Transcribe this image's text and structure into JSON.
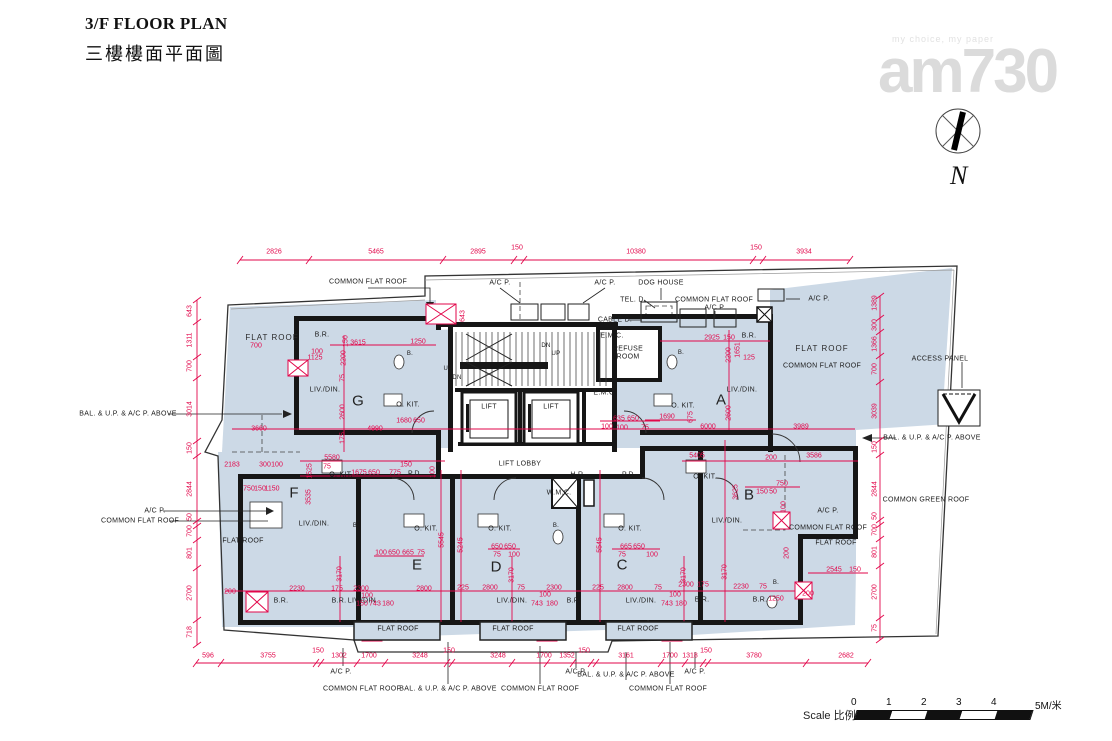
{
  "header": {
    "title_en": "3/F FLOOR PLAN",
    "title_zh": "三樓樓面平面圖"
  },
  "watermark": {
    "tagline": "my choice, my paper",
    "logo": "am730"
  },
  "compass": {
    "label": "N"
  },
  "scale_bar": {
    "label": "Scale 比例:",
    "ticks": [
      "0",
      "1",
      "2",
      "3",
      "4"
    ],
    "unit": "5M/米"
  },
  "colors": {
    "dimension": "#e2064a",
    "plan_fill": "#ccd9e6",
    "wall": "#161616"
  },
  "plan": {
    "flat_labels": [
      {
        "t": "G",
        "x": 358,
        "y": 401
      },
      {
        "t": "A",
        "x": 721,
        "y": 400
      },
      {
        "t": "F",
        "x": 294,
        "y": 493
      },
      {
        "t": "B",
        "x": 749,
        "y": 495
      },
      {
        "t": "E",
        "x": 417,
        "y": 565
      },
      {
        "t": "D",
        "x": 496,
        "y": 567
      },
      {
        "t": "C",
        "x": 622,
        "y": 565
      }
    ],
    "text_labels": [
      {
        "t": "FLAT ROOF",
        "x": 272,
        "y": 338,
        "s": "b"
      },
      {
        "t": "FLAT ROOF",
        "x": 822,
        "y": 349,
        "s": "b"
      },
      {
        "t": "FLAT ROOF",
        "x": 836,
        "y": 543
      },
      {
        "t": "FLAT ROOF",
        "x": 243,
        "y": 541
      },
      {
        "t": "FLAT ROOF",
        "x": 398,
        "y": 629
      },
      {
        "t": "FLAT ROOF",
        "x": 513,
        "y": 629
      },
      {
        "t": "FLAT ROOF",
        "x": 638,
        "y": 629
      },
      {
        "t": "COMMON FLAT ROOF",
        "x": 368,
        "y": 282
      },
      {
        "t": "COMMON FLAT ROOF",
        "x": 714,
        "y": 300
      },
      {
        "t": "COMMON FLAT ROOF",
        "x": 822,
        "y": 366
      },
      {
        "t": "COMMON FLAT ROOF",
        "x": 828,
        "y": 528
      },
      {
        "t": "COMMON FLAT ROOF",
        "x": 140,
        "y": 521
      },
      {
        "t": "COMMON FLAT ROOF",
        "x": 362,
        "y": 689
      },
      {
        "t": "COMMON FLAT ROOF",
        "x": 540,
        "y": 689
      },
      {
        "t": "COMMON FLAT ROOF",
        "x": 668,
        "y": 689
      },
      {
        "t": "A/C P.",
        "x": 500,
        "y": 283
      },
      {
        "t": "A/C P.",
        "x": 605,
        "y": 283
      },
      {
        "t": "A/C P.",
        "x": 715,
        "y": 308
      },
      {
        "t": "A/C P.",
        "x": 819,
        "y": 299
      },
      {
        "t": "A/C P.",
        "x": 155,
        "y": 511
      },
      {
        "t": "A/C P.",
        "x": 828,
        "y": 511
      },
      {
        "t": "A/C P.",
        "x": 341,
        "y": 672
      },
      {
        "t": "A/C P.",
        "x": 576,
        "y": 672
      },
      {
        "t": "A/C P.",
        "x": 695,
        "y": 672
      },
      {
        "t": "BAL. & U.P. & A/C P. ABOVE",
        "x": 128,
        "y": 414
      },
      {
        "t": "BAL. & U.P. & A/C P. ABOVE",
        "x": 932,
        "y": 438
      },
      {
        "t": "BAL. & U.P. & A/C P. ABOVE",
        "x": 448,
        "y": 689
      },
      {
        "t": "BAL. & U.P. & A/C P. ABOVE",
        "x": 626,
        "y": 675
      },
      {
        "t": "DOG HOUSE",
        "x": 661,
        "y": 283
      },
      {
        "t": "TEL. D.",
        "x": 633,
        "y": 300
      },
      {
        "t": "CABLE D.",
        "x": 615,
        "y": 320
      },
      {
        "t": "ACCESS PANEL",
        "x": 940,
        "y": 359
      },
      {
        "t": "COMMON GREEN ROOF",
        "x": 926,
        "y": 500
      },
      {
        "t": "REFUSE",
        "x": 628,
        "y": 349
      },
      {
        "t": "ROOM",
        "x": 628,
        "y": 357
      },
      {
        "t": "LIFT",
        "x": 489,
        "y": 407
      },
      {
        "t": "LIFT",
        "x": 551,
        "y": 407
      },
      {
        "t": "LIFT LOBBY",
        "x": 520,
        "y": 464
      },
      {
        "t": "H.R.",
        "x": 578,
        "y": 475
      },
      {
        "t": "P.D.",
        "x": 629,
        "y": 475
      },
      {
        "t": "P.D.",
        "x": 415,
        "y": 474
      },
      {
        "t": "W.M.C.",
        "x": 559,
        "y": 493
      },
      {
        "t": "E.M.C.",
        "x": 612,
        "y": 336
      },
      {
        "t": "E.M.C.",
        "x": 605,
        "y": 393
      },
      {
        "t": "UP",
        "x": 556,
        "y": 354,
        "s": "t"
      },
      {
        "t": "DN",
        "x": 546,
        "y": 346,
        "s": "t"
      },
      {
        "t": "UP",
        "x": 448,
        "y": 369,
        "s": "t"
      },
      {
        "t": "DN",
        "x": 457,
        "y": 378,
        "s": "t"
      },
      {
        "t": "O. KIT.",
        "x": 408,
        "y": 405
      },
      {
        "t": "O. KIT.",
        "x": 683,
        "y": 406
      },
      {
        "t": "O. KIT.",
        "x": 341,
        "y": 475
      },
      {
        "t": "O. KIT.",
        "x": 705,
        "y": 477
      },
      {
        "t": "O. KIT.",
        "x": 426,
        "y": 529
      },
      {
        "t": "O. KIT.",
        "x": 500,
        "y": 529
      },
      {
        "t": "O. KIT.",
        "x": 630,
        "y": 529
      },
      {
        "t": "LIV./DIN.",
        "x": 325,
        "y": 390
      },
      {
        "t": "LIV./DIN.",
        "x": 742,
        "y": 390
      },
      {
        "t": "LIV./DIN.",
        "x": 314,
        "y": 524
      },
      {
        "t": "LIV./DIN.",
        "x": 727,
        "y": 521
      },
      {
        "t": "LIV./DIN.",
        "x": 363,
        "y": 601
      },
      {
        "t": "LIV./DIN.",
        "x": 512,
        "y": 601
      },
      {
        "t": "LIV./DIN.",
        "x": 641,
        "y": 601
      },
      {
        "t": "B.R.",
        "x": 322,
        "y": 335
      },
      {
        "t": "B.R.",
        "x": 749,
        "y": 336
      },
      {
        "t": "B.R.",
        "x": 281,
        "y": 601
      },
      {
        "t": "B.R.",
        "x": 339,
        "y": 601
      },
      {
        "t": "B.R.",
        "x": 574,
        "y": 601
      },
      {
        "t": "B.R.",
        "x": 702,
        "y": 600
      },
      {
        "t": "B.R.",
        "x": 760,
        "y": 600
      },
      {
        "t": "B.",
        "x": 410,
        "y": 354,
        "s": "t"
      },
      {
        "t": "B.",
        "x": 681,
        "y": 353,
        "s": "t"
      },
      {
        "t": "B.",
        "x": 356,
        "y": 526,
        "s": "t"
      },
      {
        "t": "B.",
        "x": 556,
        "y": 526,
        "s": "t"
      },
      {
        "t": "B.",
        "x": 776,
        "y": 583,
        "s": "t"
      }
    ],
    "dim_labels": [
      {
        "t": "2826",
        "x": 274,
        "y": 252
      },
      {
        "t": "5465",
        "x": 376,
        "y": 252
      },
      {
        "t": "2895",
        "x": 478,
        "y": 252
      },
      {
        "t": "150",
        "x": 517,
        "y": 248
      },
      {
        "t": "10380",
        "x": 636,
        "y": 252
      },
      {
        "t": "150",
        "x": 756,
        "y": 248
      },
      {
        "t": "3934",
        "x": 804,
        "y": 252
      },
      {
        "t": "596",
        "x": 208,
        "y": 656
      },
      {
        "t": "3755",
        "x": 268,
        "y": 656
      },
      {
        "t": "150",
        "x": 318,
        "y": 651
      },
      {
        "t": "1302",
        "x": 339,
        "y": 656
      },
      {
        "t": "1700",
        "x": 369,
        "y": 656
      },
      {
        "t": "3248",
        "x": 420,
        "y": 656
      },
      {
        "t": "150",
        "x": 449,
        "y": 651
      },
      {
        "t": "3248",
        "x": 498,
        "y": 656
      },
      {
        "t": "1700",
        "x": 544,
        "y": 656
      },
      {
        "t": "1352",
        "x": 567,
        "y": 656
      },
      {
        "t": "150",
        "x": 584,
        "y": 651
      },
      {
        "t": "3161",
        "x": 626,
        "y": 656
      },
      {
        "t": "1700",
        "x": 670,
        "y": 656
      },
      {
        "t": "1318",
        "x": 690,
        "y": 656
      },
      {
        "t": "150",
        "x": 706,
        "y": 651
      },
      {
        "t": "3780",
        "x": 754,
        "y": 656
      },
      {
        "t": "2682",
        "x": 846,
        "y": 656
      },
      {
        "t": "643",
        "x": 190,
        "y": 311,
        "r": 1
      },
      {
        "t": "1311",
        "x": 190,
        "y": 340,
        "r": 1
      },
      {
        "t": "700",
        "x": 190,
        "y": 366,
        "r": 1
      },
      {
        "t": "3014",
        "x": 190,
        "y": 409,
        "r": 1
      },
      {
        "t": "150",
        "x": 190,
        "y": 448,
        "r": 1
      },
      {
        "t": "2844",
        "x": 190,
        "y": 489,
        "r": 1
      },
      {
        "t": "50",
        "x": 190,
        "y": 517,
        "r": 1
      },
      {
        "t": "700",
        "x": 190,
        "y": 531,
        "r": 1
      },
      {
        "t": "801",
        "x": 190,
        "y": 553,
        "r": 1
      },
      {
        "t": "2700",
        "x": 190,
        "y": 593,
        "r": 1
      },
      {
        "t": "718",
        "x": 190,
        "y": 632,
        "r": 1
      },
      {
        "t": "1389",
        "x": 875,
        "y": 303,
        "r": 1
      },
      {
        "t": "300",
        "x": 875,
        "y": 325,
        "r": 1
      },
      {
        "t": "1366",
        "x": 875,
        "y": 344,
        "r": 1
      },
      {
        "t": "700",
        "x": 875,
        "y": 369,
        "r": 1
      },
      {
        "t": "3039",
        "x": 875,
        "y": 411,
        "r": 1
      },
      {
        "t": "150",
        "x": 875,
        "y": 447,
        "r": 1
      },
      {
        "t": "2844",
        "x": 875,
        "y": 489,
        "r": 1
      },
      {
        "t": "50",
        "x": 875,
        "y": 516,
        "r": 1
      },
      {
        "t": "700",
        "x": 875,
        "y": 530,
        "r": 1
      },
      {
        "t": "801",
        "x": 875,
        "y": 552,
        "r": 1
      },
      {
        "t": "2700",
        "x": 875,
        "y": 592,
        "r": 1
      },
      {
        "t": "75",
        "x": 875,
        "y": 628,
        "r": 1
      },
      {
        "t": "700",
        "x": 256,
        "y": 346
      },
      {
        "t": "100",
        "x": 317,
        "y": 352
      },
      {
        "t": "1125",
        "x": 315,
        "y": 358
      },
      {
        "t": "3615",
        "x": 358,
        "y": 343
      },
      {
        "t": "1250",
        "x": 418,
        "y": 342
      },
      {
        "t": "643",
        "x": 463,
        "y": 316,
        "r": 1
      },
      {
        "t": "150",
        "x": 346,
        "y": 341,
        "r": 1
      },
      {
        "t": "2200",
        "x": 344,
        "y": 358,
        "r": 1
      },
      {
        "t": "75",
        "x": 343,
        "y": 378,
        "r": 1
      },
      {
        "t": "2600",
        "x": 343,
        "y": 412,
        "r": 1
      },
      {
        "t": "175",
        "x": 343,
        "y": 438,
        "r": 1
      },
      {
        "t": "3660",
        "x": 259,
        "y": 429
      },
      {
        "t": "4990",
        "x": 375,
        "y": 429
      },
      {
        "t": "1680",
        "x": 404,
        "y": 421
      },
      {
        "t": "650",
        "x": 419,
        "y": 421
      },
      {
        "t": "2925",
        "x": 712,
        "y": 338
      },
      {
        "t": "150",
        "x": 729,
        "y": 338
      },
      {
        "t": "2200",
        "x": 729,
        "y": 355,
        "r": 1
      },
      {
        "t": "1651",
        "x": 738,
        "y": 350,
        "r": 1
      },
      {
        "t": "125",
        "x": 749,
        "y": 358
      },
      {
        "t": "2600",
        "x": 729,
        "y": 413,
        "r": 1
      },
      {
        "t": "1690",
        "x": 667,
        "y": 417
      },
      {
        "t": "675",
        "x": 691,
        "y": 417,
        "r": 1
      },
      {
        "t": "6000",
        "x": 708,
        "y": 427
      },
      {
        "t": "3989",
        "x": 801,
        "y": 427
      },
      {
        "t": "635",
        "x": 619,
        "y": 419
      },
      {
        "t": "650",
        "x": 633,
        "y": 419
      },
      {
        "t": "100",
        "x": 622,
        "y": 428
      },
      {
        "t": "75",
        "x": 645,
        "y": 428
      },
      {
        "t": "100",
        "x": 607,
        "y": 427
      },
      {
        "t": "5580",
        "x": 332,
        "y": 458
      },
      {
        "t": "1525",
        "x": 310,
        "y": 471,
        "r": 1
      },
      {
        "t": "75",
        "x": 327,
        "y": 467
      },
      {
        "t": "1675",
        "x": 359,
        "y": 473
      },
      {
        "t": "650",
        "x": 374,
        "y": 473
      },
      {
        "t": "775",
        "x": 395,
        "y": 473
      },
      {
        "t": "150",
        "x": 406,
        "y": 465
      },
      {
        "t": "100",
        "x": 433,
        "y": 472,
        "r": 1
      },
      {
        "t": "3535",
        "x": 309,
        "y": 497,
        "r": 1
      },
      {
        "t": "2183",
        "x": 232,
        "y": 465
      },
      {
        "t": "300",
        "x": 265,
        "y": 465
      },
      {
        "t": "100",
        "x": 277,
        "y": 465
      },
      {
        "t": "750",
        "x": 249,
        "y": 489
      },
      {
        "t": "150",
        "x": 260,
        "y": 489
      },
      {
        "t": "1150",
        "x": 272,
        "y": 489
      },
      {
        "t": "100",
        "x": 381,
        "y": 553
      },
      {
        "t": "650",
        "x": 394,
        "y": 553
      },
      {
        "t": "665",
        "x": 408,
        "y": 553
      },
      {
        "t": "75",
        "x": 421,
        "y": 553
      },
      {
        "t": "650",
        "x": 497,
        "y": 547
      },
      {
        "t": "650",
        "x": 510,
        "y": 547
      },
      {
        "t": "75",
        "x": 497,
        "y": 555
      },
      {
        "t": "100",
        "x": 514,
        "y": 555
      },
      {
        "t": "665",
        "x": 626,
        "y": 547
      },
      {
        "t": "650",
        "x": 639,
        "y": 547
      },
      {
        "t": "75",
        "x": 622,
        "y": 555
      },
      {
        "t": "100",
        "x": 652,
        "y": 555
      },
      {
        "t": "5545",
        "x": 442,
        "y": 540,
        "r": 1
      },
      {
        "t": "5245",
        "x": 461,
        "y": 545,
        "r": 1
      },
      {
        "t": "5545",
        "x": 600,
        "y": 545,
        "r": 1
      },
      {
        "t": "3170",
        "x": 340,
        "y": 574,
        "r": 1
      },
      {
        "t": "3170",
        "x": 512,
        "y": 575,
        "r": 1
      },
      {
        "t": "3170",
        "x": 684,
        "y": 575,
        "r": 1
      },
      {
        "t": "3170",
        "x": 725,
        "y": 572,
        "r": 1
      },
      {
        "t": "200",
        "x": 230,
        "y": 592
      },
      {
        "t": "2230",
        "x": 297,
        "y": 589
      },
      {
        "t": "175",
        "x": 337,
        "y": 589
      },
      {
        "t": "2300",
        "x": 361,
        "y": 589
      },
      {
        "t": "2800",
        "x": 424,
        "y": 589
      },
      {
        "t": "100",
        "x": 367,
        "y": 596
      },
      {
        "t": "150",
        "x": 362,
        "y": 604
      },
      {
        "t": "743",
        "x": 375,
        "y": 604
      },
      {
        "t": "180",
        "x": 388,
        "y": 604
      },
      {
        "t": "225",
        "x": 463,
        "y": 588
      },
      {
        "t": "2800",
        "x": 490,
        "y": 588
      },
      {
        "t": "75",
        "x": 521,
        "y": 588
      },
      {
        "t": "2300",
        "x": 554,
        "y": 588
      },
      {
        "t": "100",
        "x": 545,
        "y": 595
      },
      {
        "t": "743",
        "x": 537,
        "y": 604
      },
      {
        "t": "180",
        "x": 552,
        "y": 604
      },
      {
        "t": "225",
        "x": 598,
        "y": 588
      },
      {
        "t": "2800",
        "x": 625,
        "y": 588
      },
      {
        "t": "75",
        "x": 658,
        "y": 588
      },
      {
        "t": "100",
        "x": 675,
        "y": 595
      },
      {
        "t": "743",
        "x": 667,
        "y": 604
      },
      {
        "t": "180",
        "x": 681,
        "y": 604
      },
      {
        "t": "2300",
        "x": 686,
        "y": 585
      },
      {
        "t": "175",
        "x": 703,
        "y": 585
      },
      {
        "t": "2230",
        "x": 741,
        "y": 587
      },
      {
        "t": "75",
        "x": 763,
        "y": 587
      },
      {
        "t": "1250",
        "x": 776,
        "y": 599
      },
      {
        "t": "200",
        "x": 808,
        "y": 594
      },
      {
        "t": "2545",
        "x": 834,
        "y": 570
      },
      {
        "t": "150",
        "x": 855,
        "y": 570
      },
      {
        "t": "5405",
        "x": 697,
        "y": 456
      },
      {
        "t": "200",
        "x": 771,
        "y": 458
      },
      {
        "t": "3586",
        "x": 814,
        "y": 456
      },
      {
        "t": "750",
        "x": 782,
        "y": 484
      },
      {
        "t": "150",
        "x": 762,
        "y": 492
      },
      {
        "t": "50",
        "x": 773,
        "y": 492
      },
      {
        "t": "100",
        "x": 784,
        "y": 507,
        "r": 1
      },
      {
        "t": "3625",
        "x": 736,
        "y": 492,
        "r": 1
      },
      {
        "t": "200",
        "x": 787,
        "y": 553,
        "r": 1
      }
    ]
  }
}
